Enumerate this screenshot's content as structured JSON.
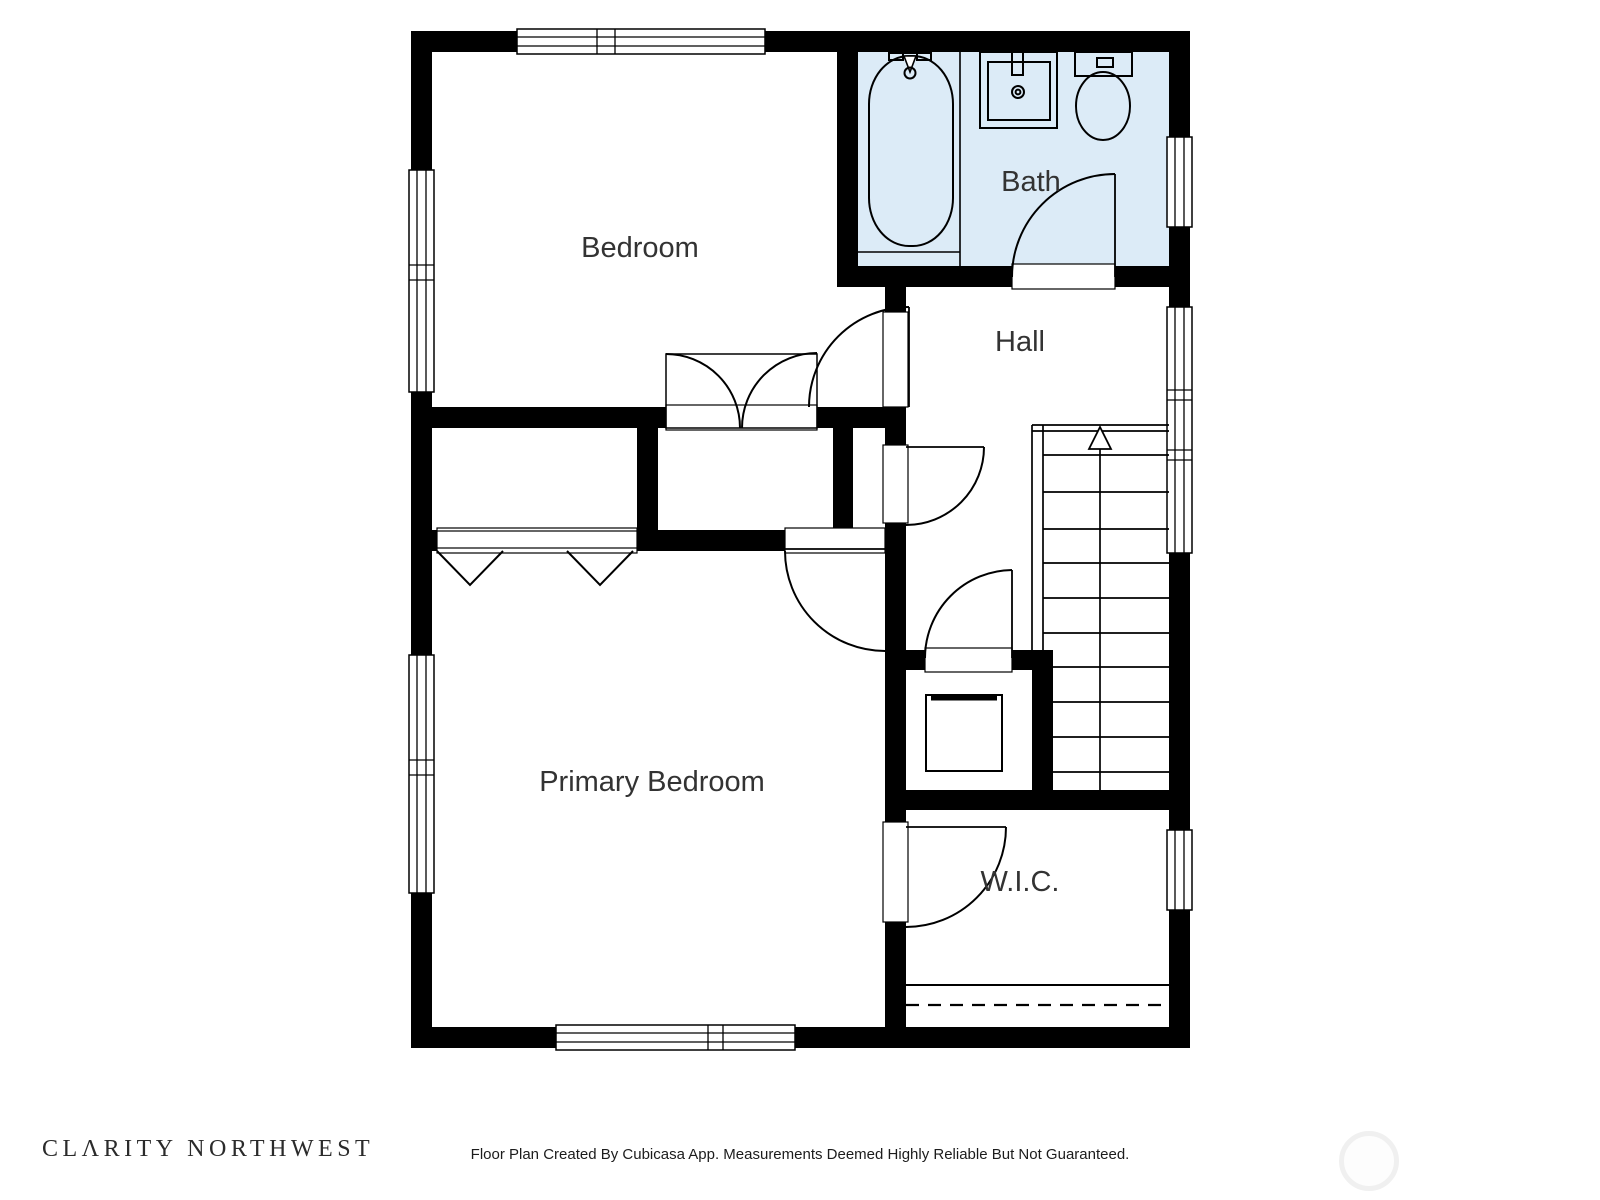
{
  "page": {
    "background": "#ffffff"
  },
  "floor_plan": {
    "colors": {
      "wall": "#000000",
      "bath_fill": "#dcebf7",
      "line": "#000000",
      "label": "#333333"
    },
    "rooms": [
      {
        "name": "bedroom",
        "label": "Bedroom"
      },
      {
        "name": "bath",
        "label": "Bath"
      },
      {
        "name": "hall",
        "label": "Hall"
      },
      {
        "name": "primary-bedroom",
        "label": "Primary Bedroom"
      },
      {
        "name": "walk-in-closet",
        "label": "W.I.C."
      }
    ],
    "fixtures": [
      {
        "name": "bathtub"
      },
      {
        "name": "sink"
      },
      {
        "name": "toilet"
      },
      {
        "name": "washer"
      },
      {
        "name": "stairs",
        "direction": "up"
      }
    ]
  },
  "footer": {
    "logo_text": "CLΛRITY NORTHWEST",
    "disclaimer": "Floor Plan Created By Cubicasa App. Measurements Deemed Highly Reliable But Not Guaranteed."
  }
}
